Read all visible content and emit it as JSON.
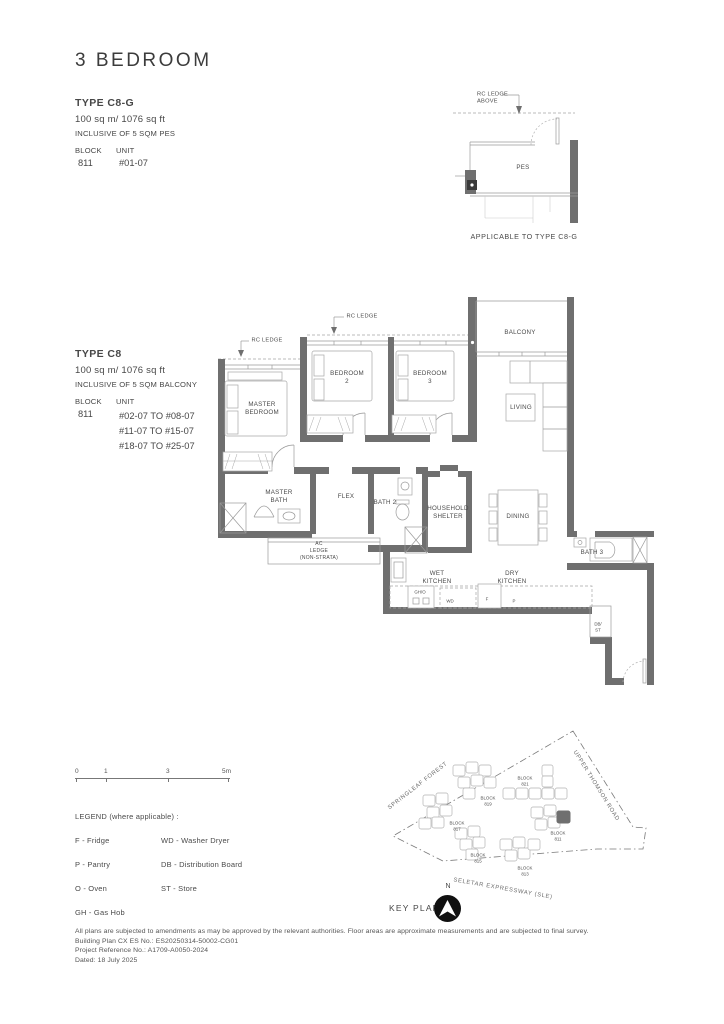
{
  "page_title": "3 BEDROOM",
  "type_c8g": {
    "name": "TYPE C8-G",
    "area": "100 sq m/ 1076 sq ft",
    "inclusive": "INCLUSIVE OF 5 SQM PES",
    "block_label": "BLOCK",
    "unit_label": "UNIT",
    "block": "811",
    "unit": "#01-07"
  },
  "pes_plan": {
    "rc_ledge_above": "RC LEDGE\nABOVE",
    "room": "PES",
    "caption": "APPLICABLE TO TYPE C8-G"
  },
  "type_c8": {
    "name": "TYPE C8",
    "area": "100 sq m/ 1076 sq ft",
    "inclusive": "INCLUSIVE OF 5 SQM BALCONY",
    "block_label": "BLOCK",
    "unit_label": "UNIT",
    "block": "811",
    "units": "#02-07 TO #08-07\n#11-07 TO #15-07\n#18-07 TO #25-07"
  },
  "plan_labels": {
    "rc_ledge_left": "RC LEDGE",
    "rc_ledge_top": "RC LEDGE",
    "master_bedroom": "MASTER\nBEDROOM",
    "bedroom2": "BEDROOM\n2",
    "bedroom3": "BEDROOM\n3",
    "balcony": "BALCONY",
    "living": "LIVING",
    "master_bath": "MASTER\nBATH",
    "flex": "FLEX",
    "bath2": "BATH 2",
    "household_shelter": "HOUSEHOLD\nSHELTER",
    "ac_ledge": "AC\nLEDGE\n(NON-STRATA)",
    "dining": "DINING",
    "bath3": "BATH 3",
    "wet_kitchen": "WET\nKITCHEN",
    "dry_kitchen": "DRY\nKITCHEN",
    "db_st": "DB/\nST",
    "gh_o": "GH/O",
    "wd": "WD",
    "f": "F",
    "p": "P"
  },
  "scale_bar": {
    "t0": "0",
    "t1": "1",
    "t3": "3",
    "t5": "5m"
  },
  "legend": {
    "title": "LEGEND (where applicable) :",
    "col1": [
      "F - Fridge",
      "P - Pantry",
      "O - Oven",
      "GH - Gas Hob"
    ],
    "col2": [
      "WD - Washer Dryer",
      "DB - Distribution Board",
      "ST - Store"
    ]
  },
  "key_plan": {
    "label": "KEY PLAN",
    "north": "N",
    "roads": {
      "springleaf": "SPRINGLEAF FOREST",
      "upper_thomson": "UPPER THOMSON ROAD",
      "seletar": "SELETAR EXPRESSWAY (SLE)"
    },
    "blocks": [
      {
        "name": "BLOCK\n821"
      },
      {
        "name": "BLOCK\n819"
      },
      {
        "name": "BLOCK\n817"
      },
      {
        "name": "BLOCK\n815"
      },
      {
        "name": "BLOCK\n813"
      },
      {
        "name": "BLOCK\n811"
      }
    ]
  },
  "footer": {
    "line1": "All plans are subjected to amendments as may be approved by the relevant authorities. Floor areas are approximate measurements and are subjected to final survey.",
    "line2": "Building Plan CX ES No.: ES20250314-50002-CG01",
    "line3": "Project Reference No.: A1709-A0050-2024",
    "line4": "Dated: 18 July 2025"
  }
}
